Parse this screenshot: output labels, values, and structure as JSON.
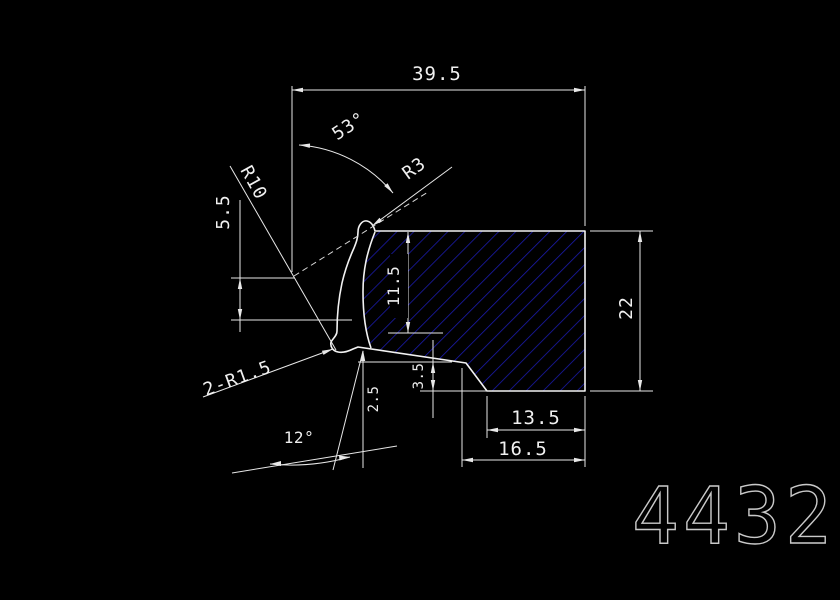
{
  "drawing": {
    "number": "4432",
    "dimensions": {
      "top_width": "39.5",
      "top_angle": "53°",
      "radius_r10": "R10",
      "left_height": "5.5",
      "radius_r3": "R3",
      "inner_height": "11.5",
      "right_height": "22",
      "fillets": "2-R1.5",
      "lip_step": "2.5",
      "step_height": "3.5",
      "bottom_angle": "12°",
      "bottom_width_inner": "13.5",
      "bottom_width_outer": "16.5"
    },
    "colors": {
      "background": "#000000",
      "line": "#e8e8e8",
      "hatch": "#1a1aa8",
      "number_text": "#c9c9c9"
    }
  }
}
